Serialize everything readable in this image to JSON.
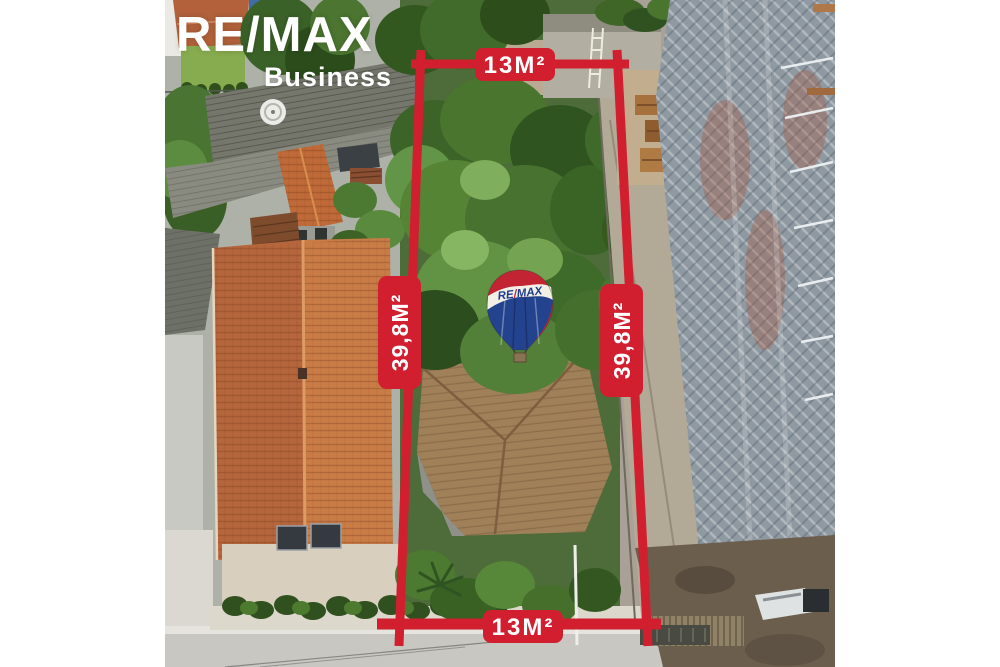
{
  "branding": {
    "name": "RE/MAX",
    "division": "Business"
  },
  "balloon": {
    "text_left": "RE",
    "slash": "/",
    "text_right": "MAX"
  },
  "measurements": {
    "front_width": "13M²",
    "back_width": "13M²",
    "left_depth": "39,8M²",
    "right_depth": "39,8M²"
  },
  "colors": {
    "dimension_red": "#d11f2f",
    "logo_white": "#ffffff",
    "balloon_red": "#c32433",
    "balloon_blue": "#24438f",
    "balloon_text_blue": "#1f3c8c",
    "balloon_band_white": "#f2efe6"
  }
}
